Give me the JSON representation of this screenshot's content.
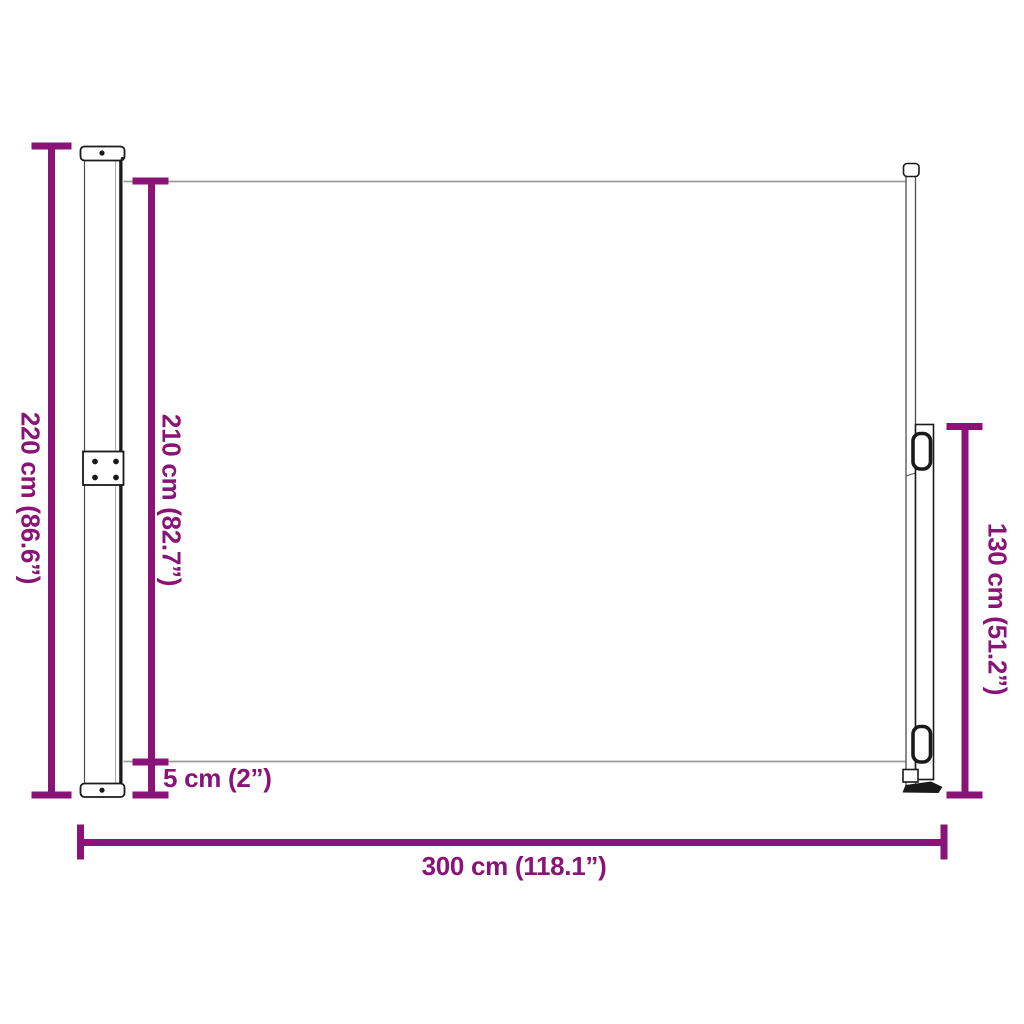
{
  "diagram": {
    "kind": "product-dimension-diagram",
    "subject": "retractable side awning",
    "background": "#ffffff"
  },
  "colors": {
    "dimension": "#8A1377",
    "structure_dark": "#1a1a1a",
    "structure_mid": "#4d4d4d",
    "structure_light": "#adadad",
    "fabric_line": "#9b9b9b"
  },
  "measurements": [
    {
      "id": "total-height",
      "label": "220 cm (86.6”)",
      "cm": 220,
      "inches": 86.6,
      "orientation": "vertical"
    },
    {
      "id": "fabric-height",
      "label": "210 cm (82.7”)",
      "cm": 210,
      "inches": 82.7,
      "orientation": "vertical"
    },
    {
      "id": "pole-height",
      "label": "130 cm (51.2”)",
      "cm": 130,
      "inches": 51.2,
      "orientation": "vertical"
    },
    {
      "id": "bottom-gap",
      "label": "5 cm (2”)",
      "cm": 5,
      "inches": 2,
      "orientation": "horizontal"
    },
    {
      "id": "total-width",
      "label": "300 cm (118.1”)",
      "cm": 300,
      "inches": 118.1,
      "orientation": "horizontal"
    }
  ]
}
